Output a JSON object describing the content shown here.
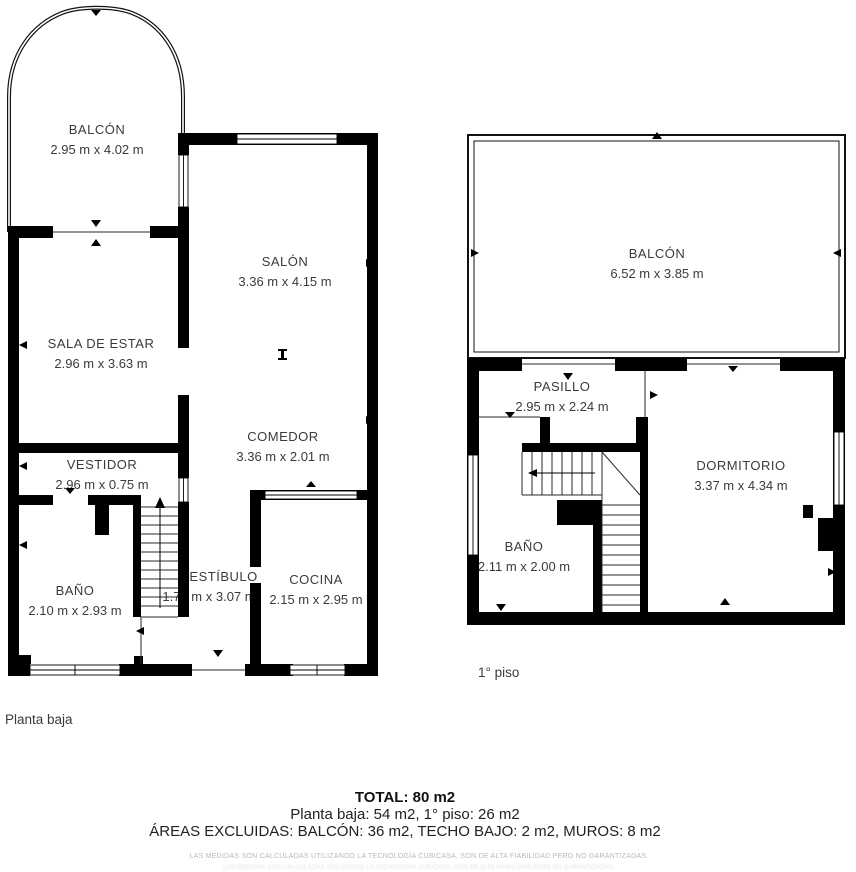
{
  "plans": {
    "ground": {
      "floor_label": "Planta baja",
      "rooms": [
        {
          "id": "balcon",
          "name": "BALCÓN",
          "dims": "2.95 m x 4.02 m"
        },
        {
          "id": "salon",
          "name": "SALÓN",
          "dims": "3.36 m x 4.15 m"
        },
        {
          "id": "sala_de_estar",
          "name": "SALA DE ESTAR",
          "dims": "2.96 m x 3.63 m"
        },
        {
          "id": "vestidor",
          "name": "VESTIDOR",
          "dims": "2.96 m x 0.75 m"
        },
        {
          "id": "comedor",
          "name": "COMEDOR",
          "dims": "3.36 m x 2.01 m"
        },
        {
          "id": "bano",
          "name": "BAÑO",
          "dims": "2.10 m x 2.93 m"
        },
        {
          "id": "vestibulo",
          "name": "VESTÍBULO",
          "dims": "1.76 m x 3.07 m"
        },
        {
          "id": "cocina",
          "name": "COCINA",
          "dims": "2.15 m x 2.95 m"
        }
      ]
    },
    "first": {
      "floor_label": "1° piso",
      "rooms": [
        {
          "id": "balcon",
          "name": "BALCÓN",
          "dims": "6.52 m x 3.85 m"
        },
        {
          "id": "pasillo",
          "name": "PASILLO",
          "dims": "2.95 m x 2.24 m"
        },
        {
          "id": "dormitorio",
          "name": "DORMITORIO",
          "dims": "3.37 m x 4.34 m"
        },
        {
          "id": "bano",
          "name": "BAÑO",
          "dims": "2.11 m x 2.00 m"
        }
      ]
    }
  },
  "summary": {
    "total": "TOTAL: 80 m2",
    "floors": "Planta baja: 54 m2, 1° piso: 26 m2",
    "excluded": "ÁREAS EXCLUIDAS: BALCÓN: 36 m2, TECHO BAJO: 2 m2, MUROS: 8 m2"
  },
  "disclaimer": "LAS MEDIDAS SON CALCULADAS UTILIZANDO LA TECNOLOGÍA CUBICASA, SON DE ALTA FIABILIDAD PERO NO GARANTIZADAS.",
  "colors": {
    "wall": "#000000",
    "thin_line": "#2a2a2a",
    "room_text": "#3b3b3b",
    "footer_text": "#1f1f1f",
    "disclaimer_text": "#b9b9b9",
    "background": "#ffffff"
  }
}
